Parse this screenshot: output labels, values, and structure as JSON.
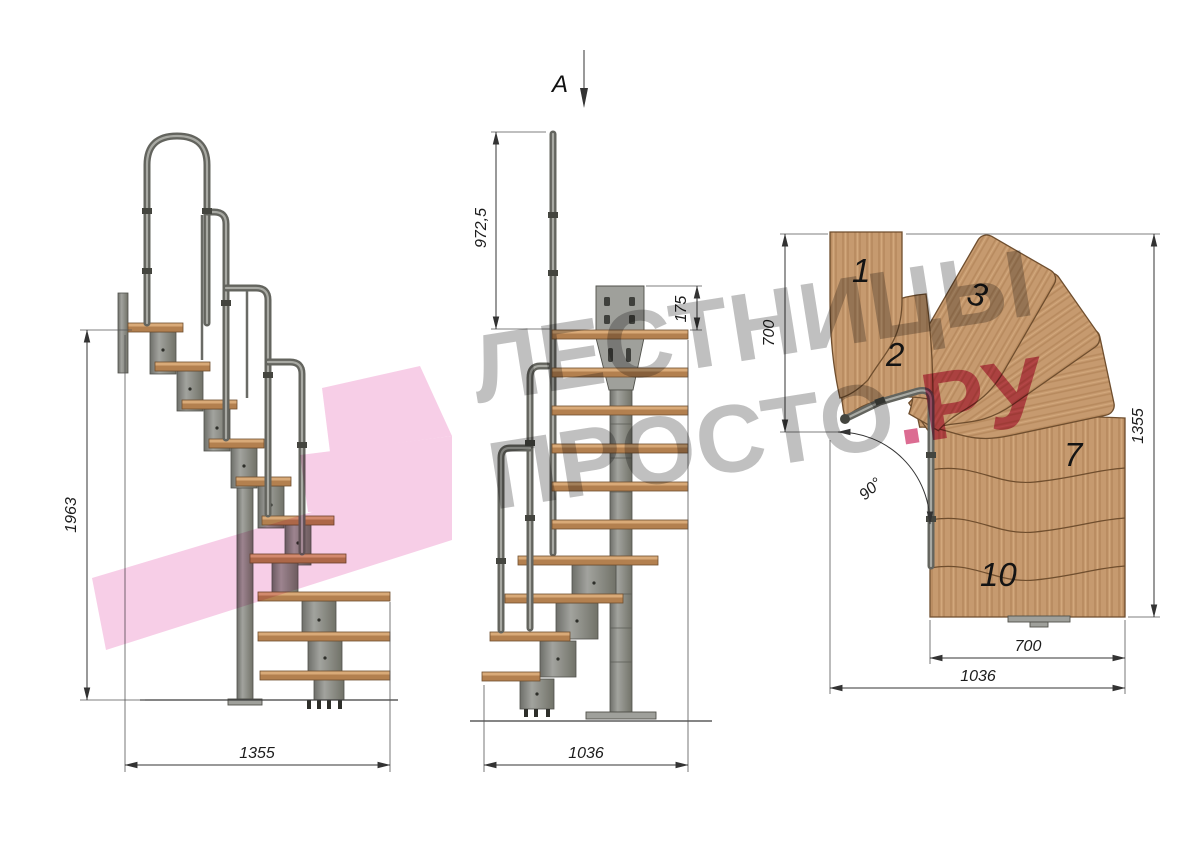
{
  "title": "Modular staircase technical drawing",
  "watermark": {
    "line1": "ЛЕСТНИЦЫ",
    "line2_gray": "ПРОСТО",
    "line2_pink": ".РУ"
  },
  "side_view": {
    "height_dim": "1963",
    "width_dim": "1355"
  },
  "front_view": {
    "section_label": "А",
    "rail_height_dim": "972,5",
    "plate_height_dim": "175",
    "width_dim": "1036"
  },
  "plan_view": {
    "upper_run_dim": "700",
    "total_length_dim": "1355",
    "angle_dim": "90°",
    "tread_width_dim": "700",
    "total_width_dim": "1036",
    "step_numbers": [
      "1",
      "2",
      "3",
      "7",
      "10"
    ]
  },
  "colors": {
    "wood-top": "#d9aa78",
    "wood-face": "#b3804f",
    "wood-line": "#6f4e2e",
    "metal": "#8b8c86",
    "metal-dark": "#63645e",
    "metal-light": "#a8a9a3",
    "wm-gray": "#b5b5b5",
    "wm-pink": "#d6527f",
    "logo-pink": "#f2b0d8"
  }
}
